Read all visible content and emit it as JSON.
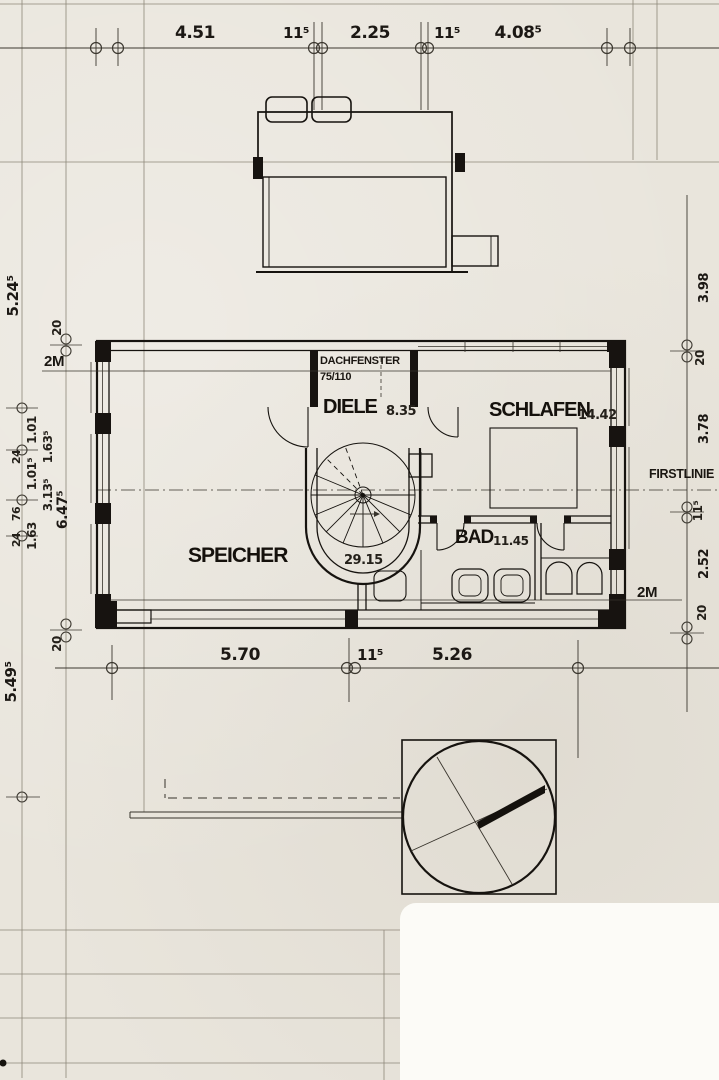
{
  "drawing": {
    "rooms": [
      {
        "name": "SPEICHER",
        "area": "29.15"
      },
      {
        "name": "DIELE",
        "area": "8.35"
      },
      {
        "name": "SCHLAFEN",
        "area": "14.42"
      },
      {
        "name": "BAD",
        "area": "11.45"
      }
    ],
    "annotations": {
      "dachfenster": "DACHFENSTER",
      "dachfenster_size": "75/110",
      "firstlinie": "FIRSTLINIE",
      "two_meter_left": "2M",
      "two_meter_right": "2M"
    },
    "dims_top": [
      "4.51",
      "11⁵",
      "2.25",
      "11⁵",
      "4.08⁵"
    ],
    "dims_bottom": [
      "5.70",
      "11⁵",
      "5.26"
    ],
    "dims_left": [
      "5.24⁵",
      "20",
      "1.01",
      "1.63⁵",
      "24",
      "1.01⁵",
      "3.13⁵",
      "76",
      "24",
      "1.63",
      "6.47⁵",
      "20",
      "5.49⁵"
    ],
    "dims_right": [
      "3.98",
      "20",
      "3.78",
      "11⁵",
      "2.52",
      "20"
    ]
  }
}
